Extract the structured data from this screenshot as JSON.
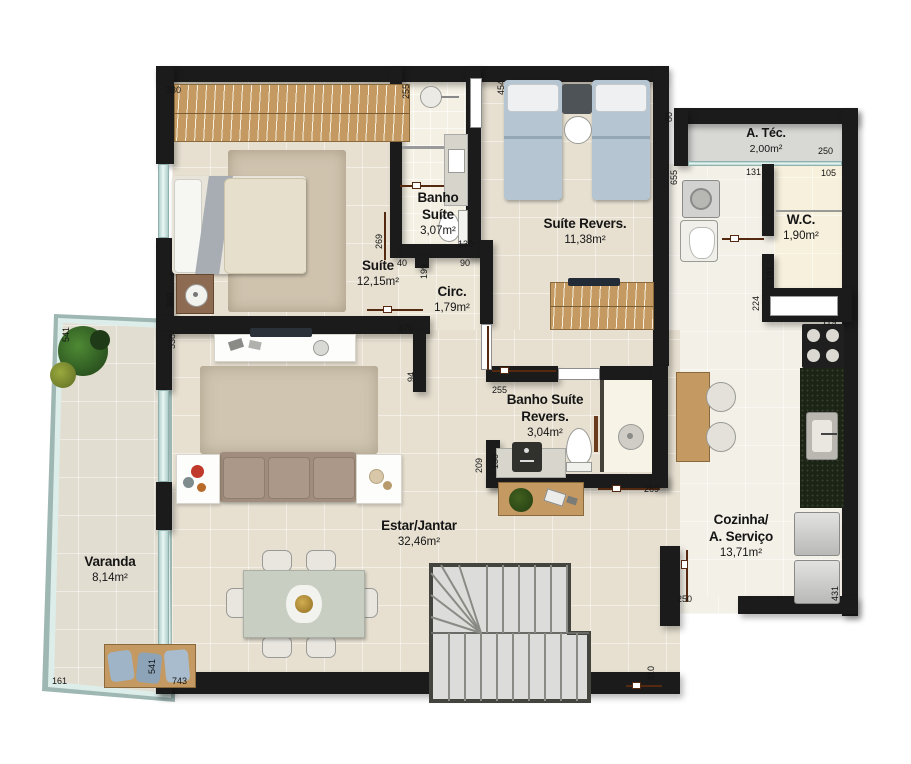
{
  "rooms": {
    "suite": {
      "name": "Suíte",
      "area": "12,15m²"
    },
    "banho_suite": {
      "name": "Banho\nSuíte",
      "area": "3,07m²"
    },
    "suite_revers": {
      "name": "Suíte Revers.",
      "area": "11,38m²"
    },
    "circ": {
      "name": "Circ.",
      "area": "1,79m²"
    },
    "banho_suite_revers": {
      "name": "Banho Suíte\nRevers.",
      "area": "3,04m²"
    },
    "atec": {
      "name": "A. Téc.",
      "area": "2,00m²"
    },
    "wc": {
      "name": "W.C.",
      "area": "1,90m²"
    },
    "cozinha": {
      "name": "Cozinha/\nA. Serviço",
      "area": "13,71m²"
    },
    "estar": {
      "name": "Estar/Jantar",
      "area": "32,46m²"
    },
    "varanda": {
      "name": "Varanda",
      "area": "8,14m²"
    }
  },
  "dims": {
    "d330": "330",
    "d255a": "255",
    "d454": "454",
    "d80": "80",
    "d250a": "250",
    "d131": "131",
    "d105": "105",
    "d655": "655",
    "d181": "181",
    "d224": "224",
    "d119": "119",
    "d269a": "269",
    "d130a": "130",
    "d40": "40",
    "d199": "199",
    "d90": "90",
    "d360": "360",
    "d538": "538",
    "d370": "370",
    "d94": "94",
    "d255b": "255",
    "d130b": "130",
    "d209": "209",
    "d269b": "269",
    "d250b": "250",
    "d431": "431",
    "d310": "310",
    "d161": "161",
    "d541a": "541",
    "d541b": "541",
    "d743": "743"
  },
  "colors": {
    "wall": "#1b1b1b",
    "floor_beige": "#e7e0d1",
    "floor_bath": "#f4f0e3",
    "floor_atec": "#d8d8d5",
    "wood": "#c49a62",
    "glass": "#cde6e3",
    "dim_line": "#55290f",
    "counter_dark": "#1b2415",
    "bed_blue": "#b5c5d1",
    "sofa": "#a08d7d"
  }
}
